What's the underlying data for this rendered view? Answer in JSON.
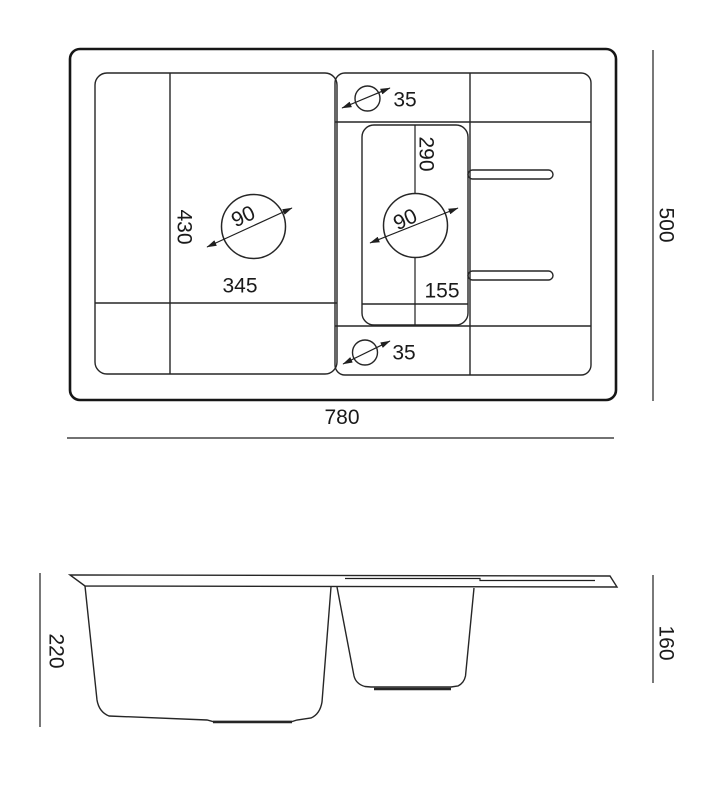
{
  "drawing": {
    "type": "kitchen sink technical drawing",
    "background_color": "#ffffff",
    "line_color": "#1f1f1f"
  },
  "top_view": {
    "overall_width_mm": "780",
    "overall_depth_mm": "500",
    "main_bowl_depth_mm": "430",
    "main_bowl_width_mm": "345",
    "main_drain_diameter_mm": "90",
    "small_bowl_length_mm": "290",
    "small_bowl_width_mm": "155",
    "small_drain_diameter_mm": "90",
    "tap_hole_top_diameter_mm": "35",
    "tap_hole_bottom_diameter_mm": "35"
  },
  "side_view": {
    "main_bowl_depth_mm": "220",
    "small_bowl_depth_mm": "160"
  }
}
